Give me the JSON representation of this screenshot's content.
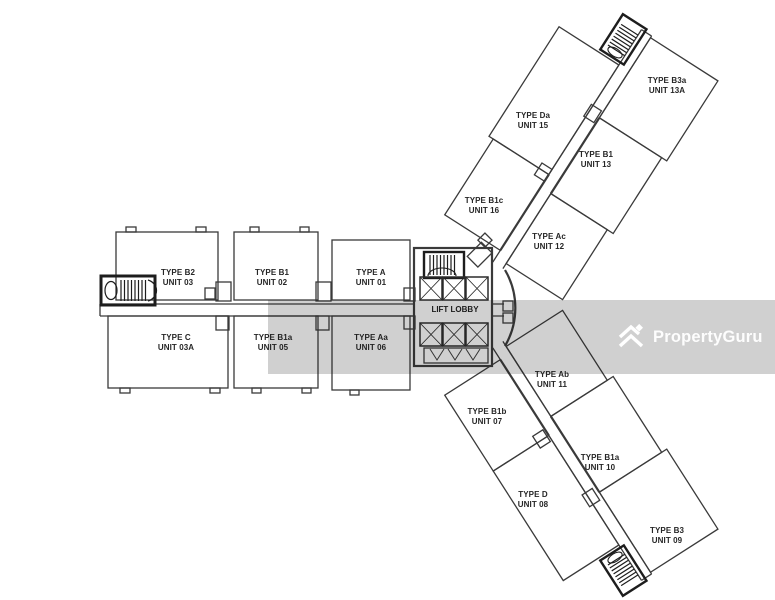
{
  "colors": {
    "plan_line": "#3a3a3a",
    "label_text": "#262626",
    "watermark_overlay": "rgba(20,20,20,0.20)",
    "watermark_logo": "#ffffff"
  },
  "watermark": {
    "brand": "PropertyGuru"
  },
  "plan": {
    "lift_lobby_label": "LIFT LOBBY",
    "units": [
      {
        "type": "TYPE B2",
        "unit": "UNIT 03"
      },
      {
        "type": "TYPE B1",
        "unit": "UNIT 02"
      },
      {
        "type": "TYPE A",
        "unit": "UNIT 01"
      },
      {
        "type": "TYPE C",
        "unit": "UNIT 03A"
      },
      {
        "type": "TYPE B1a",
        "unit": "UNIT 05"
      },
      {
        "type": "TYPE Aa",
        "unit": "UNIT 06"
      },
      {
        "type": "TYPE Da",
        "unit": "UNIT 15"
      },
      {
        "type": "TYPE B1",
        "unit": "UNIT 13"
      },
      {
        "type": "TYPE B3a",
        "unit": "UNIT 13A"
      },
      {
        "type": "TYPE B1c",
        "unit": "UNIT 16"
      },
      {
        "type": "TYPE Ac",
        "unit": "UNIT 12"
      },
      {
        "type": "TYPE Ab",
        "unit": "UNIT 11"
      },
      {
        "type": "TYPE B1b",
        "unit": "UNIT 07"
      },
      {
        "type": "TYPE B1a",
        "unit": "UNIT 10"
      },
      {
        "type": "TYPE D",
        "unit": "UNIT 08"
      },
      {
        "type": "TYPE B3",
        "unit": "UNIT 09"
      }
    ]
  }
}
